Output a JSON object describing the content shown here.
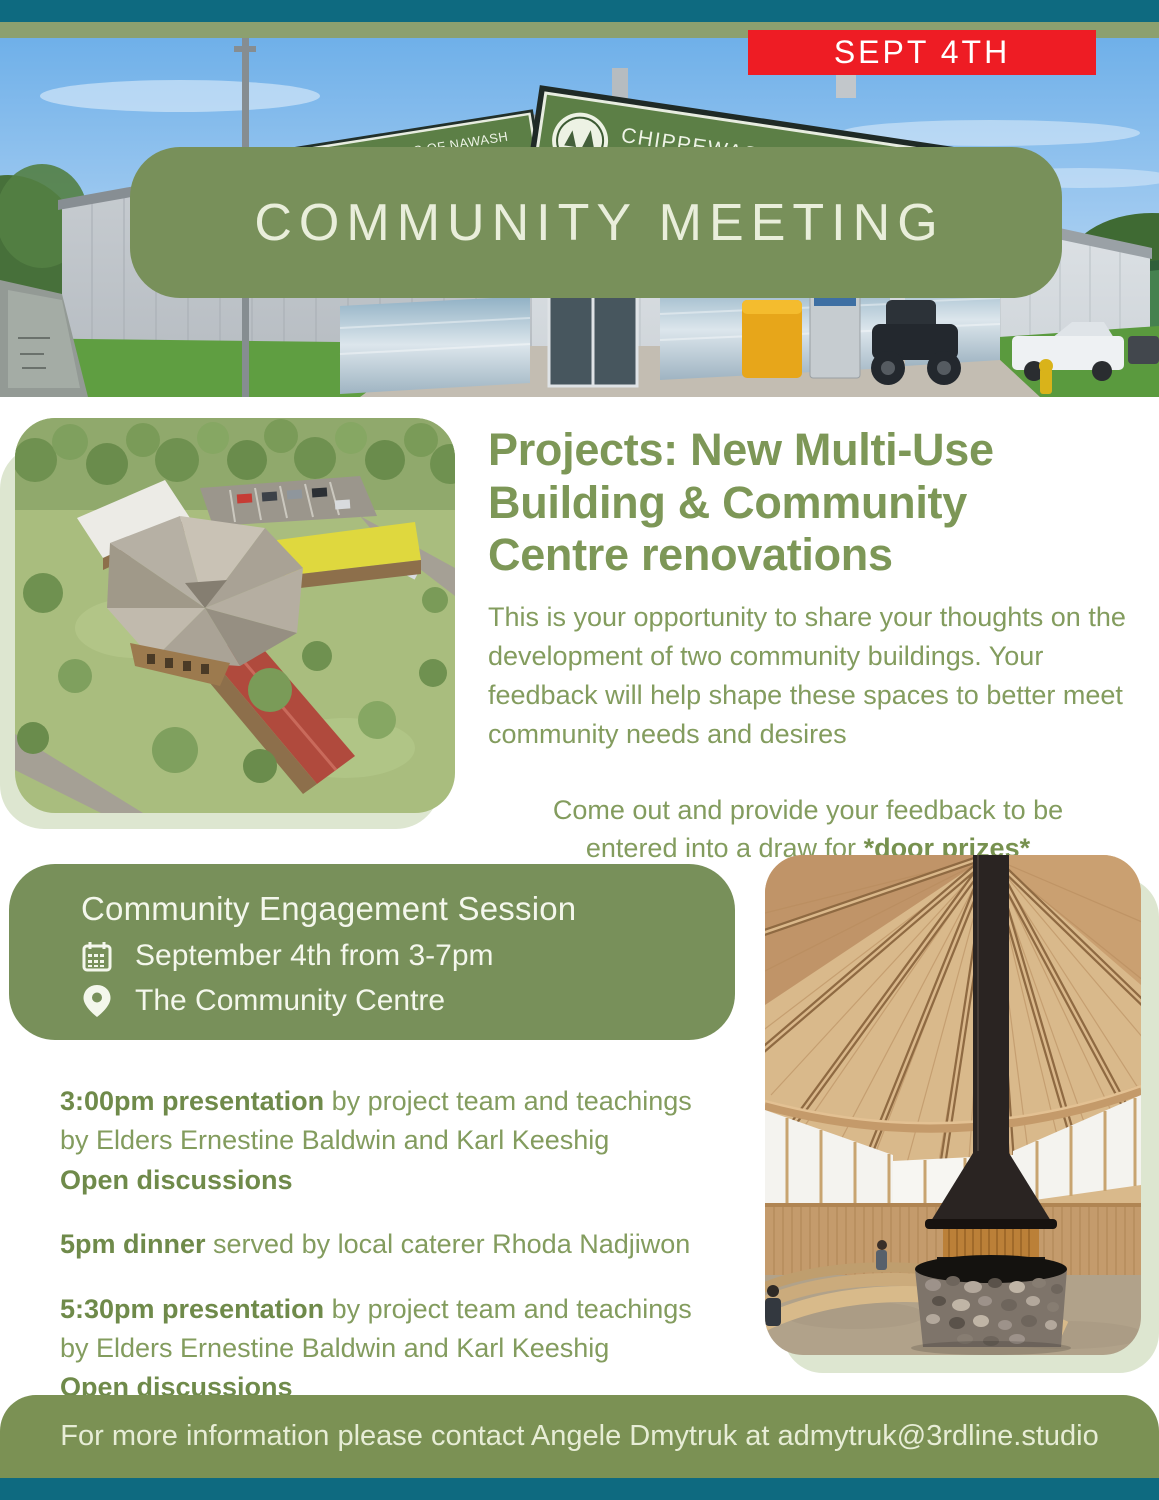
{
  "hero": {
    "date_badge": "SEPT 4TH",
    "title": "COMMUNITY MEETING",
    "building_sign": {
      "line1": "CHIPPEWAS OF NAWASH",
      "line2": "UNCEDED FIRST NATION"
    }
  },
  "projects": {
    "heading": "Projects: New Multi-Use Building & Community Centre renovations",
    "body": "This is your opportunity to share your thoughts on the development of two community buildings. Your feedback will help shape these spaces to better meet community needs and desires",
    "cta_prefix": "Come out and provide your feedback to be entered into a draw for ",
    "cta_highlight": "*door prizes*"
  },
  "session": {
    "title": "Community Engagement Session",
    "date": "September 4th from 3-7pm",
    "location": "The Community Centre"
  },
  "schedule": [
    {
      "lead": "3:00pm presentation",
      "rest": " by project team and teachings by Elders Ernestine Baldwin and Karl Keeshig",
      "note": "Open discussions"
    },
    {
      "lead": "5pm dinner",
      "rest": " served by local caterer Rhoda Nadjiwon",
      "note": ""
    },
    {
      "lead": "5:30pm presentation",
      "rest": " by project team and teachings by Elders Ernestine Baldwin and Karl Keeshig",
      "note": "Open discussions"
    }
  ],
  "footer": {
    "contact": "For more information please contact Angele Dmytruk at admytruk@3rdline.studio"
  },
  "colors": {
    "teal": "#0e6a80",
    "olive_strip": "#8ca06f",
    "pill_green": "#78905a",
    "heading_green": "#7d9757",
    "body_green": "#839c5e",
    "bold_green": "#6f8a4a",
    "cream": "#e9eedb",
    "red": "#ee1c24",
    "sage_shadow": "#dde6d0"
  }
}
